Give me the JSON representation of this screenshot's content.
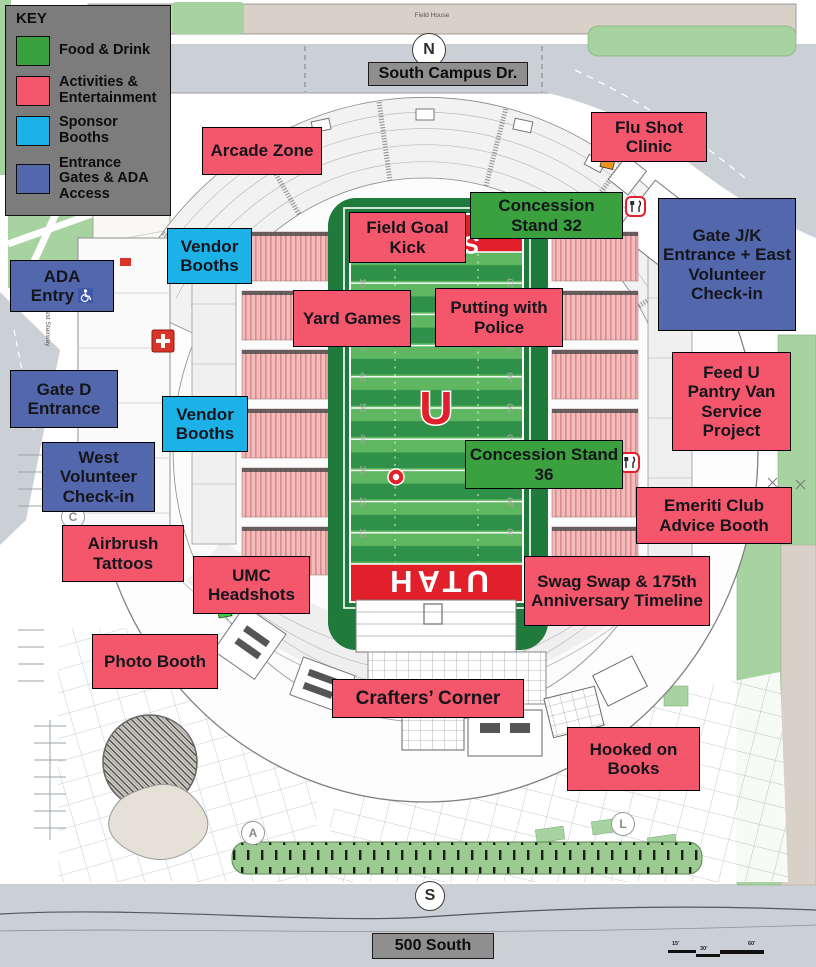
{
  "key": {
    "title": "KEY",
    "items": [
      {
        "label": "Food & Drink",
        "type": "food",
        "color": "#3BA13F"
      },
      {
        "label": "Activities & Entertainment",
        "type": "activity",
        "color": "#F4576C"
      },
      {
        "label": "Sponsor Booths",
        "type": "sponsor",
        "color": "#1CB2E8"
      },
      {
        "label": "Entrance Gates & ADA Access",
        "type": "entrance",
        "color": "#5368AC"
      }
    ]
  },
  "roads": {
    "north_label": "South Campus Dr.",
    "south_label": "500 South"
  },
  "places": {
    "field_house": "Field House",
    "west_stairway": "West Stairway"
  },
  "field": {
    "south_endzone": "UTAH",
    "north_endzone_letter": "S",
    "center_logo_letter": "U",
    "yard_numbers": [
      "10",
      "20",
      "30",
      "40",
      "50",
      "40",
      "30",
      "20",
      "10"
    ]
  },
  "markers": [
    {
      "label": "N"
    },
    {
      "label": "S"
    },
    {
      "label": "A"
    },
    {
      "label": "C"
    },
    {
      "label": "L"
    }
  ],
  "labels": [
    {
      "text": "Arcade Zone",
      "type": "activity"
    },
    {
      "text": "Flu Shot Clinic",
      "type": "activity"
    },
    {
      "text": "Concession Stand 32",
      "type": "food"
    },
    {
      "text": "Field Goal Kick",
      "type": "activity"
    },
    {
      "text": "Gate J/K Entrance + East Volunteer Check-in",
      "type": "entrance"
    },
    {
      "text": "Vendor Booths",
      "type": "sponsor"
    },
    {
      "text": "ADA Entry",
      "type": "entrance",
      "icon": "wheelchair"
    },
    {
      "text": "Yard Games",
      "type": "activity"
    },
    {
      "text": "Putting with Police",
      "type": "activity"
    },
    {
      "text": "Feed U Pantry Van Service Project",
      "type": "activity"
    },
    {
      "text": "Gate D Entrance",
      "type": "entrance"
    },
    {
      "text": "Vendor Booths",
      "type": "sponsor"
    },
    {
      "text": "Concession Stand 36",
      "type": "food"
    },
    {
      "text": "West Volunteer Check-in",
      "type": "entrance"
    },
    {
      "text": "Emeriti Club Advice Booth",
      "type": "activity"
    },
    {
      "text": "Airbrush Tattoos",
      "type": "activity"
    },
    {
      "text": "UMC Headshots",
      "type": "activity"
    },
    {
      "text": "Swag Swap & 175th Anniversary Timeline",
      "type": "activity"
    },
    {
      "text": "Photo Booth",
      "type": "activity"
    },
    {
      "text": "Crafters’ Corner",
      "type": "activity"
    },
    {
      "text": "Hooked on Books",
      "type": "activity"
    }
  ],
  "scale_bar": {
    "ticks": [
      "15'",
      "30'",
      "60'"
    ]
  },
  "icons": {
    "wheelchair": "white wheelchair symbol on blue square",
    "first_aid": "white cross on red square",
    "food_service": "fork and knife in red rounded square"
  },
  "colors": {
    "food": "#3BA13F",
    "activity": "#F4576C",
    "sponsor": "#1CB2E8",
    "entrance": "#5368AC",
    "key_bg": "#7C7C7C",
    "road": "#CAD0D6",
    "lawn": "#A7D3A0",
    "building": "#D9D1C8",
    "field_green_dark": "#1F7A3C",
    "field_stripe_light": "#5FB761",
    "field_stripe_dark": "#2F9049",
    "endzone_red": "#E2202B",
    "seating_pink": "#F3BBBB"
  }
}
